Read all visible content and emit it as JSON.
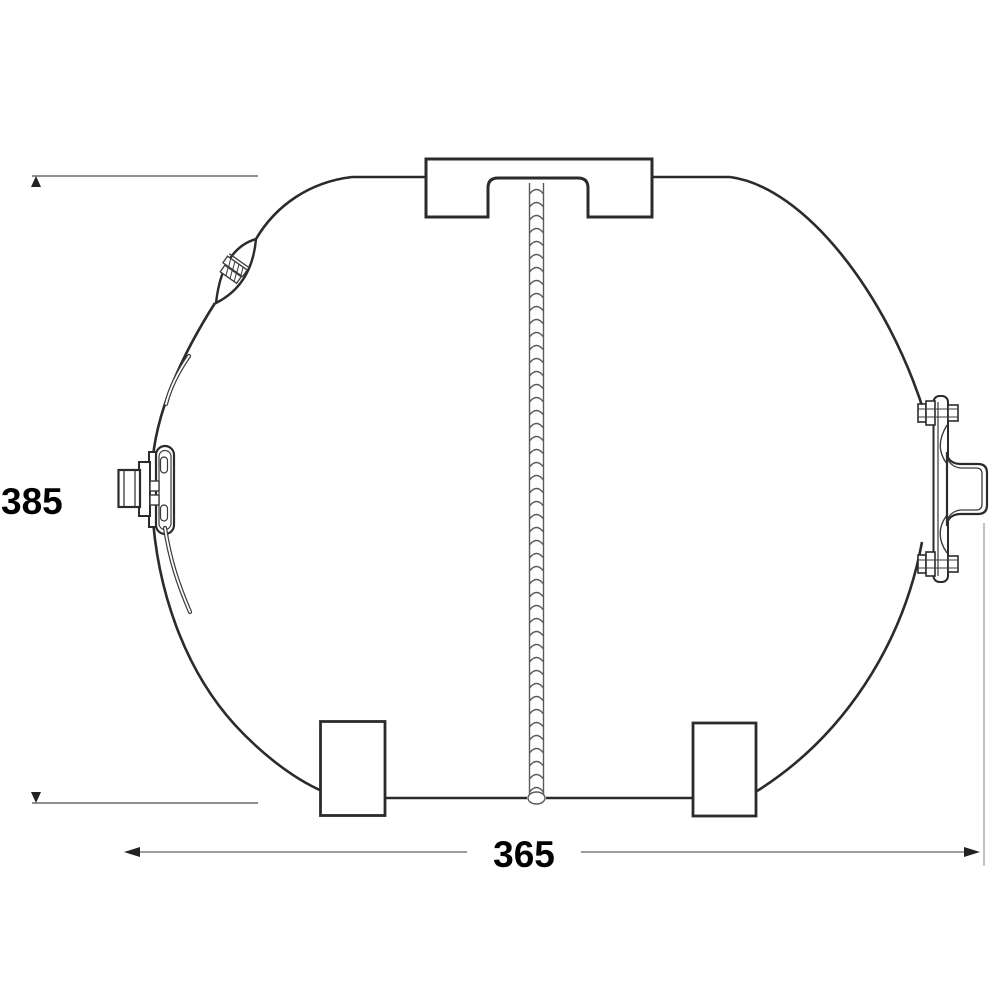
{
  "drawing": {
    "subject": "Horizontal pressure tank dimensional drawing",
    "dimensions": {
      "height": {
        "value": "385"
      },
      "width": {
        "value": "365"
      }
    },
    "colors": {
      "outline": "#2b2b2b",
      "weld_seam": "#5a5a5a",
      "dimension_line": "#8f8f8f",
      "dimension_text": "#000000",
      "background": "#ffffff"
    },
    "parts": [
      "tank-shell",
      "carry-bracket",
      "vertical-weld-seam",
      "air-valve-port",
      "water-connection-fitting",
      "mounting-flange",
      "foot-left",
      "foot-right"
    ]
  }
}
